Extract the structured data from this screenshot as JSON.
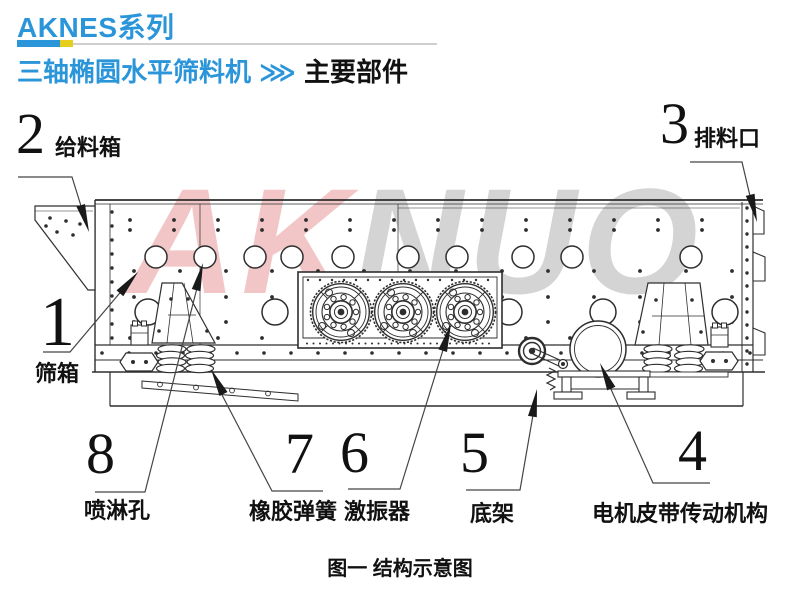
{
  "header": {
    "series": "AKNES系列",
    "machine_name": "三轴椭圆水平筛料机",
    "separator": "⋙",
    "section": "主要部件"
  },
  "watermark": {
    "part1": "AK",
    "part2": "NUO"
  },
  "diagram": {
    "caption": "图一 结构示意图",
    "labels": [
      {
        "num": "1",
        "text": "筛箱"
      },
      {
        "num": "2",
        "text": "给料箱"
      },
      {
        "num": "3",
        "text": "排料口"
      },
      {
        "num": "4",
        "text": "电机皮带传动机构"
      },
      {
        "num": "5",
        "text": "底架"
      },
      {
        "num": "6",
        "text": "激振器"
      },
      {
        "num": "7",
        "text": "橡胶弹簧"
      },
      {
        "num": "8",
        "text": "喷淋孔"
      }
    ]
  },
  "colors": {
    "accent_blue": "#2b95da",
    "accent_yellow": "#e6cf1c",
    "watermark_pink": "#f2c6c6",
    "watermark_gray": "#d4d4d4",
    "line_dark": "#2e2e2e"
  }
}
